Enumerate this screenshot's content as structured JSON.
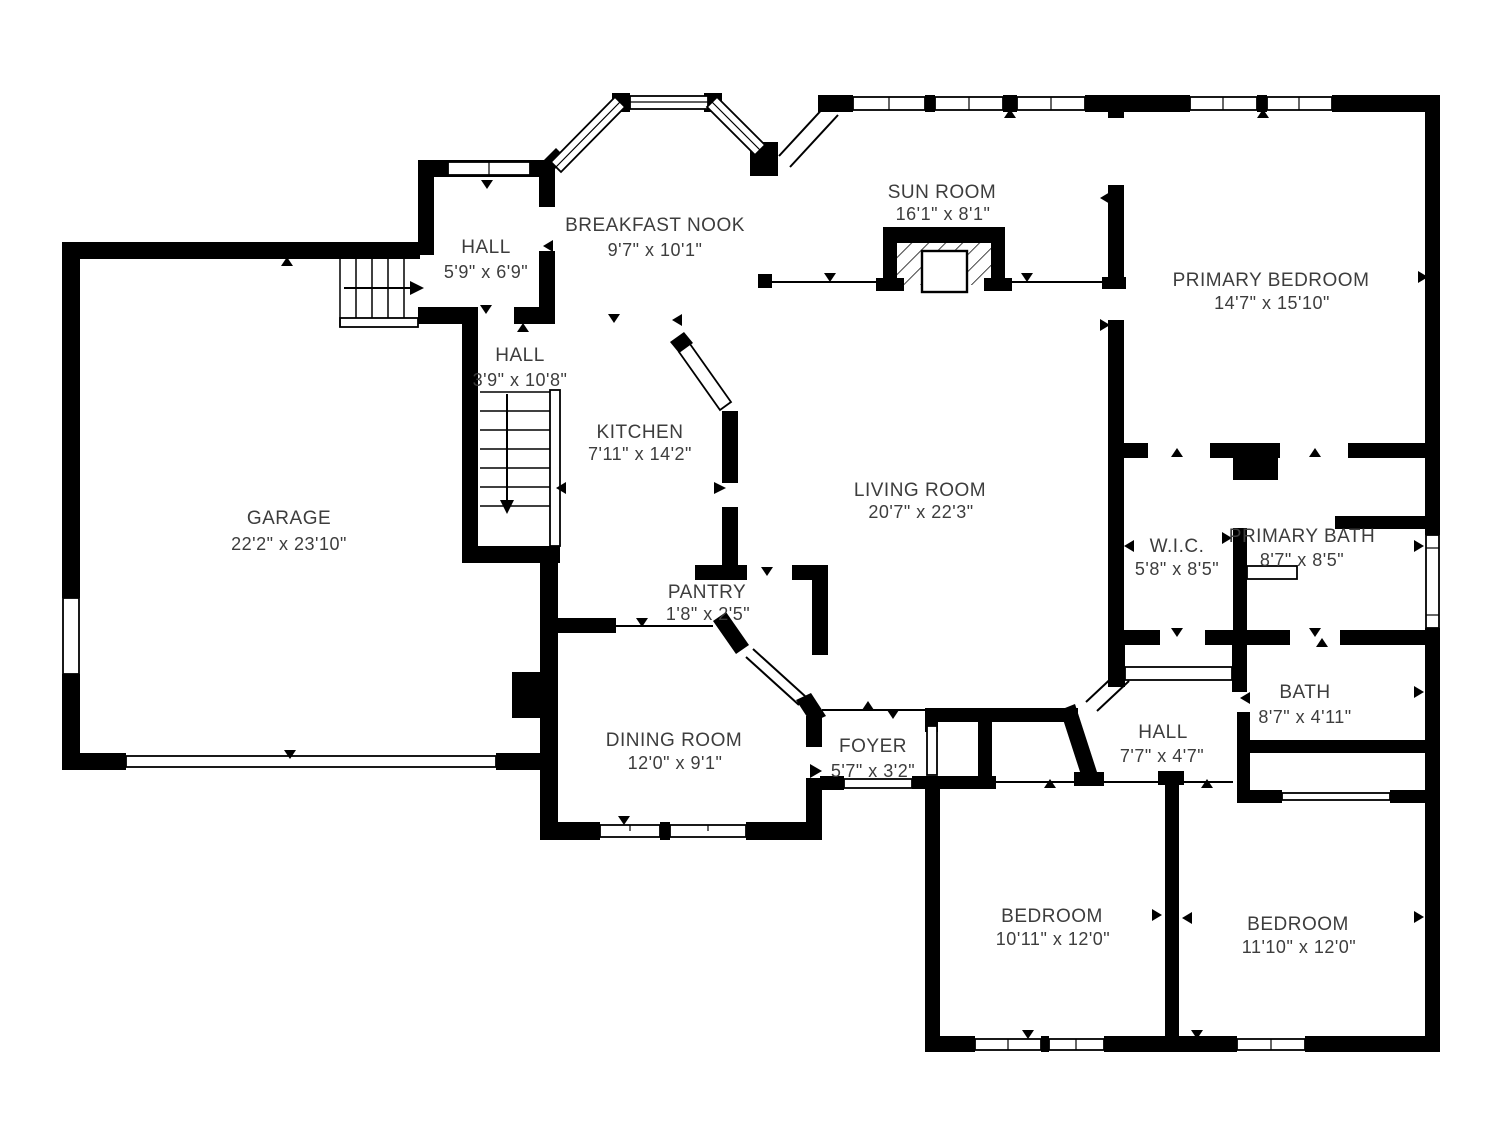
{
  "title": "First floor plan",
  "colors": {
    "wall": "#000000",
    "label_text": "#3d3d3d",
    "background": "#ffffff"
  },
  "rooms": {
    "garage": {
      "name": "GARAGE",
      "dims": "22'2\" x 23'10\""
    },
    "hall_upper": {
      "name": "HALL",
      "dims": "5'9\" x 6'9\""
    },
    "breakfast_nook": {
      "name": "BREAKFAST NOOK",
      "dims": "9'7\" x 10'1\""
    },
    "hall_stairs": {
      "name": "HALL",
      "dims": "3'9\" x 10'8\""
    },
    "kitchen": {
      "name": "KITCHEN",
      "dims": "7'11\" x 14'2\""
    },
    "sun_room": {
      "name": "SUN ROOM",
      "dims": "16'1\" x 8'1\""
    },
    "primary_bedroom": {
      "name": "PRIMARY BEDROOM",
      "dims": "14'7\" x 15'10\""
    },
    "living_room": {
      "name": "LIVING ROOM",
      "dims": "20'7\" x 22'3\""
    },
    "wic": {
      "name": "W.I.C.",
      "dims": "5'8\" x 8'5\""
    },
    "primary_bath": {
      "name": "PRIMARY BATH",
      "dims": "8'7\" x 8'5\""
    },
    "pantry": {
      "name": "PANTRY",
      "dims": "1'8\" x 2'5\""
    },
    "dining_room": {
      "name": "DINING ROOM",
      "dims": "12'0\" x 9'1\""
    },
    "foyer": {
      "name": "FOYER",
      "dims": "5'7\" x 3'2\""
    },
    "hall_bedrooms": {
      "name": "HALL",
      "dims": "7'7\" x 4'7\""
    },
    "bath": {
      "name": "BATH",
      "dims": "8'7\" x 4'11\""
    },
    "bedroom_left": {
      "name": "BEDROOM",
      "dims": "10'11\" x 12'0\""
    },
    "bedroom_right": {
      "name": "BEDROOM",
      "dims": "11'10\" x 12'0\""
    }
  }
}
